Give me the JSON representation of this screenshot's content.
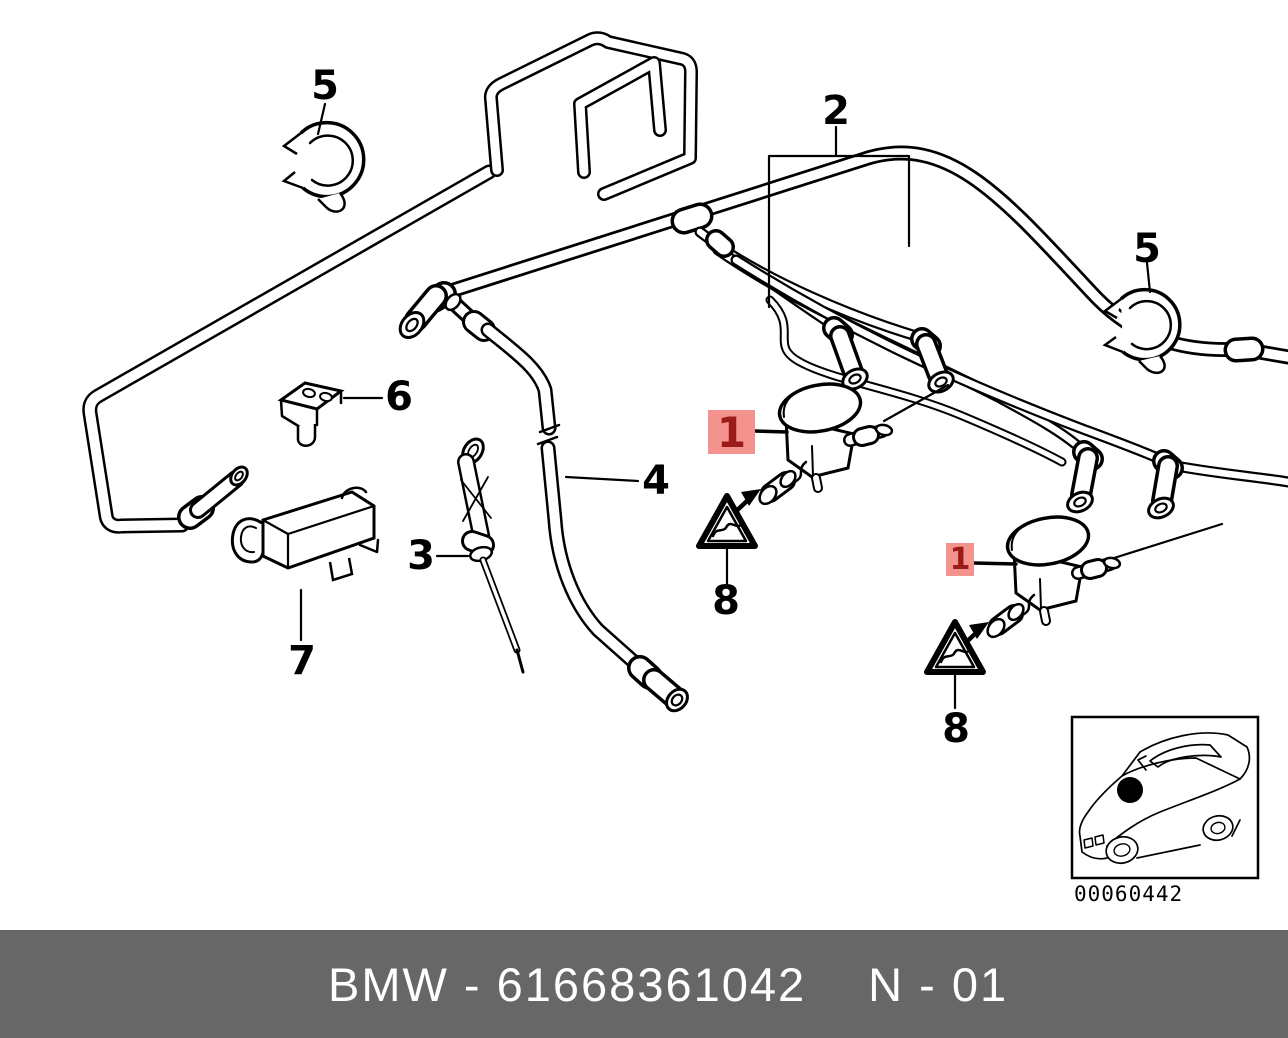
{
  "theme": {
    "page-bg": "#ffffff",
    "line": "#000000",
    "hl-bg": "#f4928e",
    "hl-text": "#9b1a1a",
    "footer-bg": "#676767",
    "footer-text": "#ffffff"
  },
  "diagram": {
    "callouts": [
      {
        "id": "5-left",
        "text": "5",
        "highlighted": false
      },
      {
        "id": "2",
        "text": "2",
        "highlighted": false
      },
      {
        "id": "5-right",
        "text": "5",
        "highlighted": false
      },
      {
        "id": "6",
        "text": "6",
        "highlighted": false
      },
      {
        "id": "4",
        "text": "4",
        "highlighted": false
      },
      {
        "id": "3",
        "text": "3",
        "highlighted": false
      },
      {
        "id": "7",
        "text": "7",
        "highlighted": false
      },
      {
        "id": "1-upper",
        "text": "1",
        "highlighted": true
      },
      {
        "id": "1-lower",
        "text": "1",
        "highlighted": true
      },
      {
        "id": "8-upper",
        "text": "8",
        "highlighted": false
      },
      {
        "id": "8-lower",
        "text": "8",
        "highlighted": false
      }
    ],
    "icons": {
      "warning_triangle": "△",
      "assembly_arrow": "➤"
    },
    "inset": {
      "image_number": "00060442"
    }
  },
  "footer": {
    "brand": "BMW",
    "part_number": "61668361042",
    "sheet": "N - 01",
    "left_text": "BMW - 61668361042",
    "right_text": "N - 01"
  }
}
